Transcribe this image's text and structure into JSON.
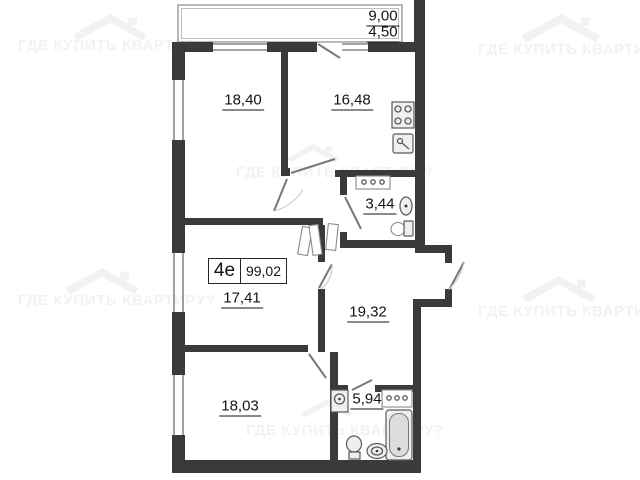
{
  "watermark": {
    "text": "ГДЕ КУПИТЬ КВАРТИРУ?",
    "icon": "house-roof-icon",
    "color": "#f2f2f2"
  },
  "apartment": {
    "type_code": "4е",
    "total_area": "99,02"
  },
  "labels": {
    "balcony_area_full": "9,00",
    "balcony_area_reduced": "4,50",
    "room_top_left": "18,40",
    "kitchen": "16,48",
    "bathroom_small": "3,44",
    "room_middle_left": "17,41",
    "hallway": "19,32",
    "room_bottom_left": "18,03",
    "bathroom_large": "5,94"
  },
  "fixtures": [
    "stove-icon",
    "kitchen-sink-icon",
    "vanity-sink-icon",
    "wall-sink-icon",
    "toilet-icon",
    "washing-machine-icon",
    "bathtub-icon",
    "round-sink-icon",
    "wardrobe-icon"
  ],
  "colors": {
    "wall": "#3a3a3a",
    "thin_line": "#777777",
    "label_text": "#141414",
    "watermark": "#f2f2f2",
    "background": "#ffffff"
  }
}
